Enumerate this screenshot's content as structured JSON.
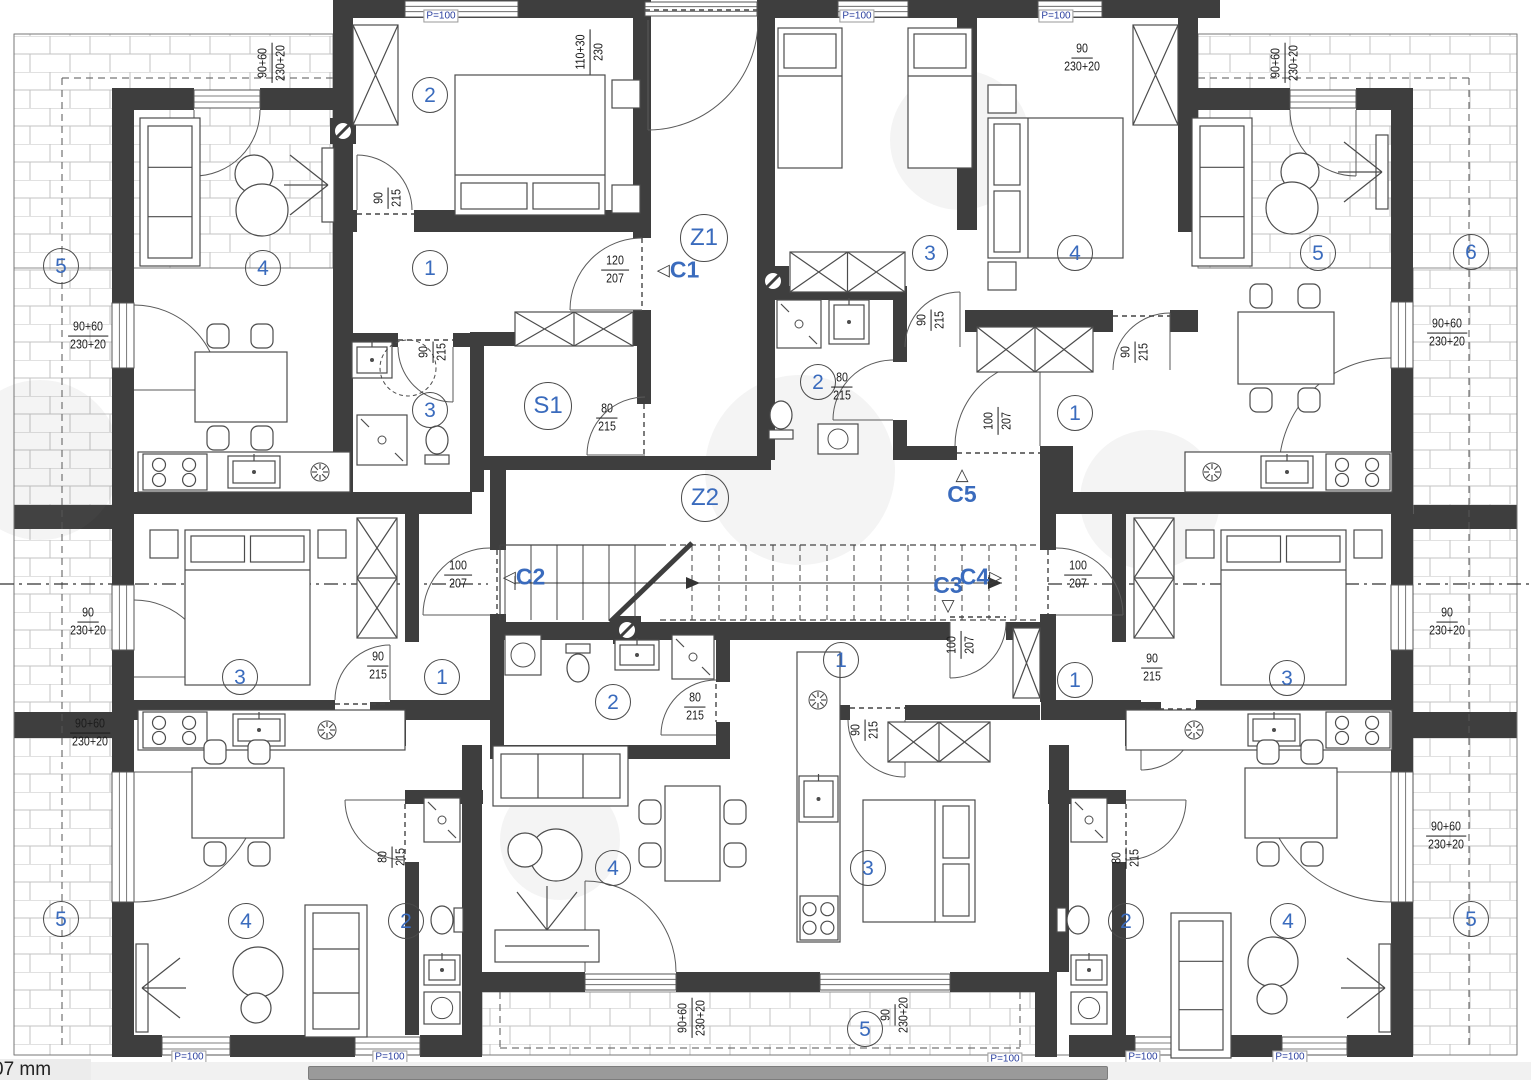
{
  "plan": {
    "title": "Apartment building floor plan",
    "rooms": [
      {
        "id": "tl-bed",
        "label": "2"
      },
      {
        "id": "tl-living",
        "label": "4"
      },
      {
        "id": "tl-hall",
        "label": "1"
      },
      {
        "id": "tl-bath",
        "label": "3"
      },
      {
        "id": "terr-tl",
        "label": "5"
      },
      {
        "id": "tc-room",
        "label": "3"
      },
      {
        "id": "tc-bath",
        "label": "2"
      },
      {
        "id": "tr-bed",
        "label": "4"
      },
      {
        "id": "tr-hall",
        "label": "1"
      },
      {
        "id": "tr-living",
        "label": "5"
      },
      {
        "id": "terr-tr",
        "label": "6"
      },
      {
        "id": "ml-bed",
        "label": "3"
      },
      {
        "id": "ml-hall",
        "label": "1"
      },
      {
        "id": "bl-living",
        "label": "4"
      },
      {
        "id": "bl-bath",
        "label": "2"
      },
      {
        "id": "terr-bl",
        "label": "5"
      },
      {
        "id": "bc-bath",
        "label": "2"
      },
      {
        "id": "bc-living",
        "label": "4"
      },
      {
        "id": "bc-hall",
        "label": "1"
      },
      {
        "id": "bc-bed",
        "label": "3"
      },
      {
        "id": "terr-bc",
        "label": "5"
      },
      {
        "id": "br-hall",
        "label": "1"
      },
      {
        "id": "mr-bed",
        "label": "3"
      },
      {
        "id": "br-bath",
        "label": "2"
      },
      {
        "id": "br-living",
        "label": "4"
      },
      {
        "id": "terr-br",
        "label": "5"
      }
    ],
    "zones": [
      {
        "id": "z1",
        "label": "Z1"
      },
      {
        "id": "z2",
        "label": "Z2"
      },
      {
        "id": "s1",
        "label": "S1"
      }
    ],
    "section_markers": [
      {
        "id": "c1",
        "label": "C1"
      },
      {
        "id": "c2",
        "label": "C2"
      },
      {
        "id": "c3",
        "label": "C3"
      },
      {
        "id": "c4",
        "label": "C4"
      },
      {
        "id": "c5",
        "label": "C5"
      }
    ],
    "dims": [
      {
        "id": "d1",
        "top": "90+60",
        "bottom": "230+20"
      },
      {
        "id": "d2",
        "top": "110+30",
        "bottom": "230"
      },
      {
        "id": "d3",
        "top": "90",
        "bottom": "230+20"
      },
      {
        "id": "d4",
        "top": "90+60",
        "bottom": "230+20"
      },
      {
        "id": "d5",
        "top": "90+60",
        "bottom": "230+20"
      },
      {
        "id": "d6",
        "top": "90",
        "bottom": "230+20"
      },
      {
        "id": "d7",
        "top": "90+60",
        "bottom": "230+20"
      },
      {
        "id": "d8",
        "top": "90+60",
        "bottom": "230+20"
      },
      {
        "id": "d9",
        "top": "90",
        "bottom": "230+20"
      },
      {
        "id": "d10",
        "top": "90+60",
        "bottom": "230+20"
      },
      {
        "id": "d11",
        "top": "90+60",
        "bottom": "230+20"
      },
      {
        "id": "d12",
        "top": "90",
        "bottom": "230+20"
      },
      {
        "id": "d13",
        "top": "90",
        "bottom": "215"
      },
      {
        "id": "d14",
        "top": "90",
        "bottom": "215"
      },
      {
        "id": "d15",
        "top": "120",
        "bottom": "207"
      },
      {
        "id": "d16",
        "top": "80",
        "bottom": "215"
      },
      {
        "id": "d17",
        "top": "80",
        "bottom": "215"
      },
      {
        "id": "d18",
        "top": "90",
        "bottom": "215"
      },
      {
        "id": "d19",
        "top": "100",
        "bottom": "207"
      },
      {
        "id": "d20",
        "top": "100",
        "bottom": "207"
      },
      {
        "id": "d21",
        "top": "90",
        "bottom": "215"
      },
      {
        "id": "d22",
        "top": "80",
        "bottom": "215"
      },
      {
        "id": "d23",
        "top": "80",
        "bottom": "215"
      },
      {
        "id": "d24",
        "top": "100",
        "bottom": "207"
      },
      {
        "id": "d25",
        "top": "90",
        "bottom": "215"
      },
      {
        "id": "d26",
        "top": "100",
        "bottom": "207"
      },
      {
        "id": "d27",
        "top": "90",
        "bottom": "215"
      },
      {
        "id": "d28",
        "top": "80",
        "bottom": "215"
      },
      {
        "id": "d29",
        "top": "90",
        "bottom": "215"
      }
    ],
    "p100_labels": [
      "P=100",
      "P=100",
      "P=100",
      "P=100",
      "P=100",
      "P=100",
      "P=100",
      "P=100"
    ]
  },
  "statusbar": {
    "text": "07 mm"
  },
  "colors": {
    "wall": "#3e3e3e",
    "label_blue": "#3a6bbd",
    "dim_text": "#1c1c1c",
    "hatch_line": "#c3c3c3",
    "scroll_track": "#f1f1f1",
    "scroll_thumb": "#9a9a9a"
  }
}
